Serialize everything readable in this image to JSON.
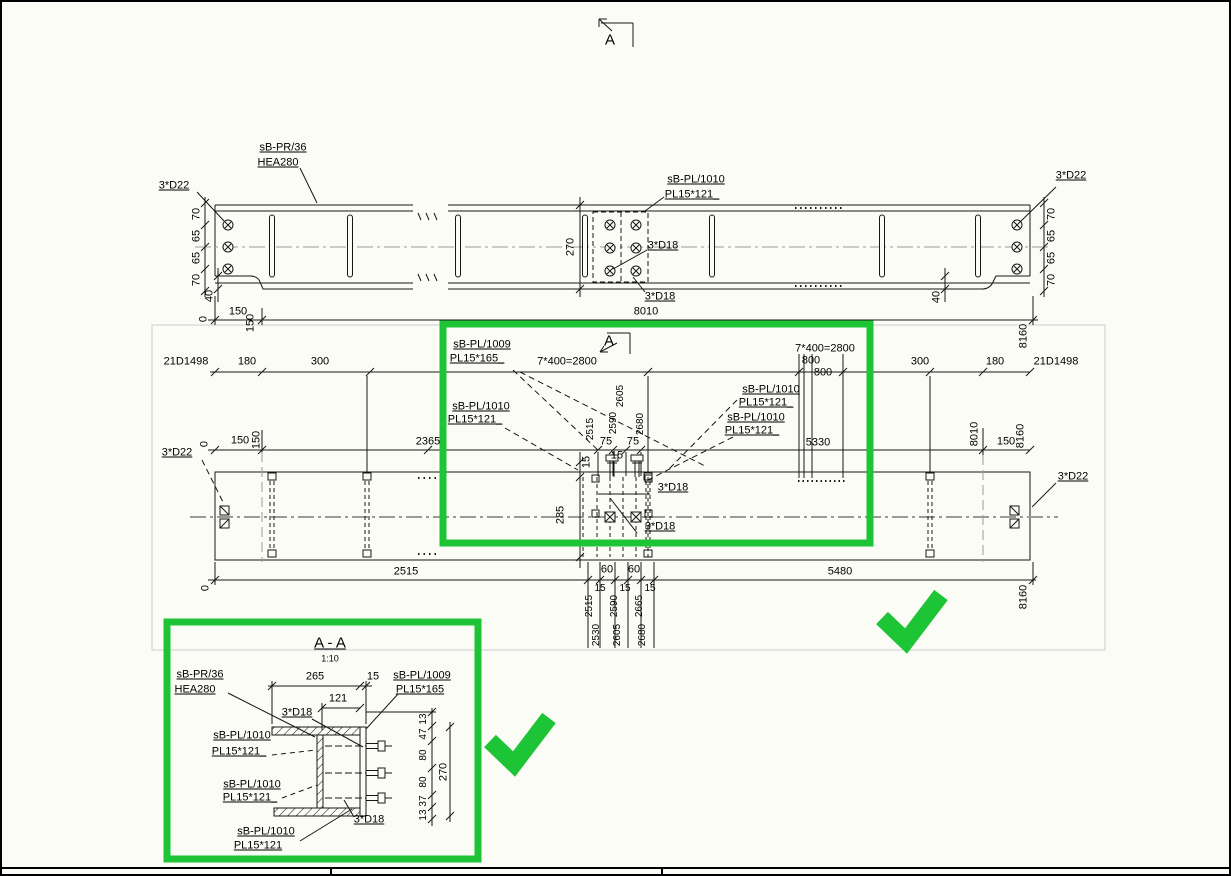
{
  "colors": {
    "highlight_green": "#1dc436",
    "centerline_gray": "#9a9a9a",
    "frame_gray": "#cccccc",
    "line_black": "#161616"
  },
  "top_marker": {
    "letter": "A"
  },
  "elevation": {
    "member_tag": {
      "l1": "sB-PR/36",
      "l2": "HEA280"
    },
    "bolts_left": "3*D22",
    "bolts_right": "3*D22",
    "plate_tag": {
      "l1": "sB-PL/1010",
      "l2": "PL15*121_"
    },
    "bolt_mid_top": "3*D18",
    "bolt_mid_bottom": "3*D18",
    "depth": "270",
    "left_dims": [
      "70",
      "65",
      "65",
      "70"
    ],
    "left_cope": "40",
    "right_dims": [
      "70",
      "65",
      "65",
      "70"
    ],
    "right_cope": "40",
    "row": {
      "datum": "0",
      "d150": "150",
      "d150_rot": "150",
      "d8010": "8010",
      "d8160": "8160"
    }
  },
  "plan": {
    "marker_letter": "A",
    "row1": {
      "left_pos": "21D1498",
      "left_180": "180",
      "left_300": "300",
      "left_spacing": "7*400=2800",
      "right_spacing": "7*400=2800",
      "right_800a": "800",
      "right_800b": "800",
      "right_300": "300",
      "right_180": "180",
      "right_pos": "21D1498"
    },
    "tag_1009": {
      "l1": "sB-PL/1009",
      "l2": "PL15*165_"
    },
    "tag_1010_left": {
      "l1": "sB-PL/1010",
      "l2": "PL15*121_"
    },
    "tag_1010_r1": {
      "l1": "sB-PL/1010",
      "l2": "PL15*121_"
    },
    "tag_1010_r2": {
      "l1": "sB-PL/1010",
      "l2": "PL15*121_"
    },
    "bolts_left": "3*D22",
    "bolts_right": "3*D22",
    "d18_top": "3*D18",
    "d18_bottom": "3*D18",
    "row2": {
      "datum": "0",
      "d150a": "150",
      "d150b": "150",
      "d2365": "2365",
      "d2515": "2515",
      "d2590": "2590",
      "d2605": "2605",
      "d75a": "75",
      "d75b": "75",
      "d2680": "2680",
      "d15a": "15",
      "d15b": "15",
      "d285": "285",
      "d5330": "5330",
      "d8010": "8010",
      "d150c": "150",
      "d8160": "8160"
    },
    "row3": {
      "datum": "0",
      "d2515": "2515",
      "d60a": "60",
      "d60b": "60",
      "d15a": "15",
      "d15b": "15",
      "d15c": "15",
      "p1a": "2515",
      "p1b": "2530",
      "p2a": "2590",
      "p2b": "2605",
      "p3a": "2665",
      "p3b": "2680",
      "d5480": "5480",
      "d8160": "8160"
    }
  },
  "section": {
    "title": "A - A",
    "scale": "1:10",
    "member_tag": {
      "l1": "sB-PR/36",
      "l2": "HEA280"
    },
    "tag_1009": {
      "l1": "sB-PL/1009",
      "l2": "PL15*165"
    },
    "tag_1010_1": {
      "l1": "sB-PL/1010",
      "l2": "PL15*121_"
    },
    "tag_1010_2": {
      "l1": "sB-PL/1010",
      "l2": "PL15*121_"
    },
    "tag_1010_3": {
      "l1": "sB-PL/1010",
      "l2": "PL15*121"
    },
    "d18_top": "3*D18",
    "d18_bottom": "3*D18",
    "d265": "265",
    "d15": "15",
    "d121": "121",
    "right_dims": [
      "13",
      "47",
      "80",
      "80",
      "37",
      "13"
    ],
    "d270": "270"
  }
}
